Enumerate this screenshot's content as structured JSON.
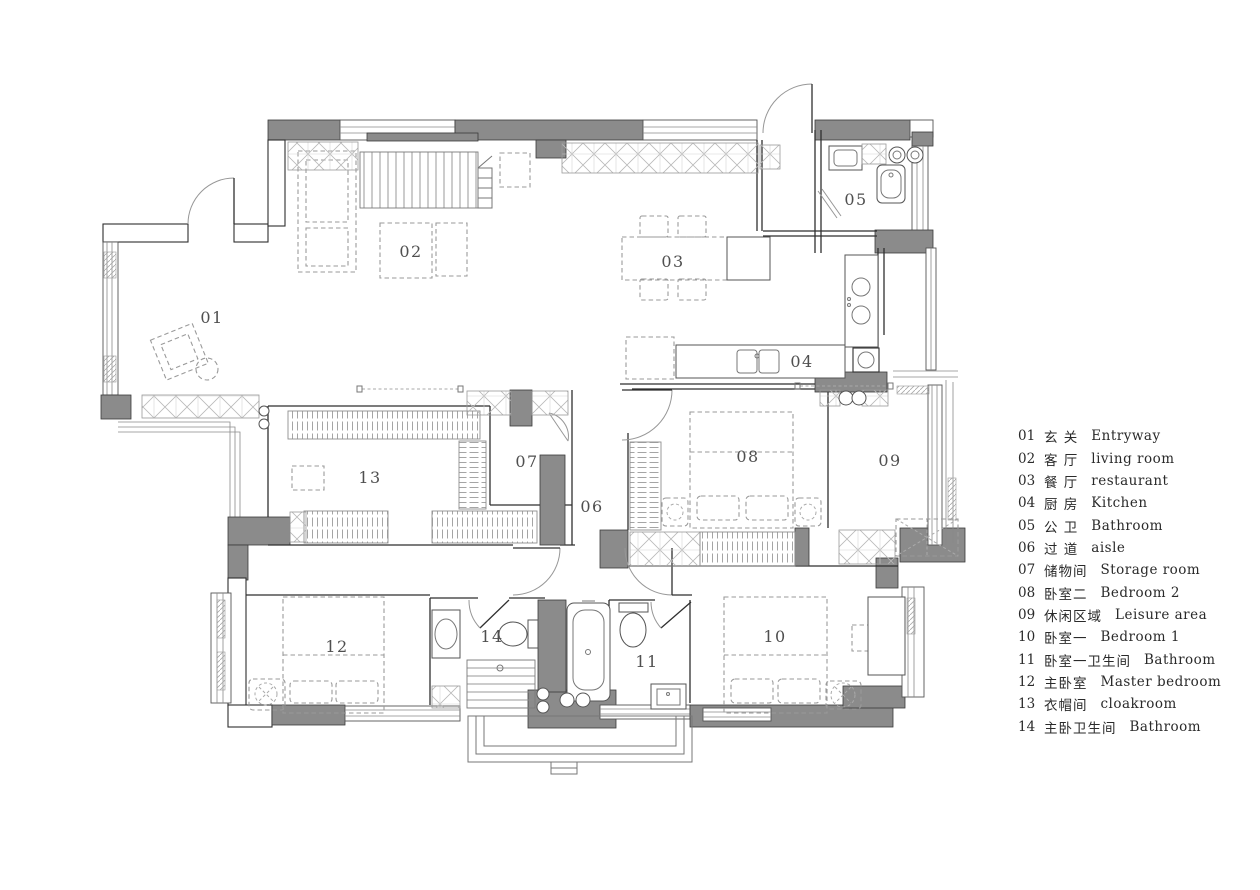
{
  "colors": {
    "background": "#ffffff",
    "wall_fill": "#8b8b8b",
    "wall_line": "#3a3a3a",
    "furniture_line": "#9a9a9a",
    "room_label": "#4f4f4f",
    "legend_text": "#2a2a2a"
  },
  "floorplan": {
    "rooms": [
      {
        "num": "01",
        "x": 212,
        "y": 318
      },
      {
        "num": "02",
        "x": 411,
        "y": 252
      },
      {
        "num": "03",
        "x": 673,
        "y": 262
      },
      {
        "num": "04",
        "x": 802,
        "y": 362
      },
      {
        "num": "05",
        "x": 856,
        "y": 200
      },
      {
        "num": "06",
        "x": 592,
        "y": 507
      },
      {
        "num": "07",
        "x": 527,
        "y": 462
      },
      {
        "num": "08",
        "x": 748,
        "y": 457
      },
      {
        "num": "09",
        "x": 890,
        "y": 461
      },
      {
        "num": "10",
        "x": 775,
        "y": 637
      },
      {
        "num": "11",
        "x": 647,
        "y": 662
      },
      {
        "num": "12",
        "x": 337,
        "y": 647
      },
      {
        "num": "13",
        "x": 370,
        "y": 478
      },
      {
        "num": "14",
        "x": 492,
        "y": 637
      }
    ]
  },
  "legend": {
    "items": [
      {
        "num": "01",
        "zh": "玄 关",
        "en": "Entryway"
      },
      {
        "num": "02",
        "zh": "客 厅",
        "en": "living room"
      },
      {
        "num": "03",
        "zh": "餐 厅",
        "en": "restaurant"
      },
      {
        "num": "04",
        "zh": "厨 房",
        "en": "Kitchen"
      },
      {
        "num": "05",
        "zh": "公 卫",
        "en": "Bathroom"
      },
      {
        "num": "06",
        "zh": "过 道",
        "en": "aisle"
      },
      {
        "num": "07",
        "zh": "储物间",
        "en": "Storage room"
      },
      {
        "num": "08",
        "zh": "卧室二",
        "en": "Bedroom 2"
      },
      {
        "num": "09",
        "zh": "休闲区域",
        "en": "Leisure area"
      },
      {
        "num": "10",
        "zh": "卧室一",
        "en": "Bedroom 1"
      },
      {
        "num": "11",
        "zh": "卧室一卫生间",
        "en": "Bathroom"
      },
      {
        "num": "12",
        "zh": "主卧室",
        "en": "Master bedroom"
      },
      {
        "num": "13",
        "zh": "衣帽间",
        "en": "cloakroom"
      },
      {
        "num": "14",
        "zh": "主卧卫生间",
        "en": "Bathroom"
      }
    ]
  }
}
